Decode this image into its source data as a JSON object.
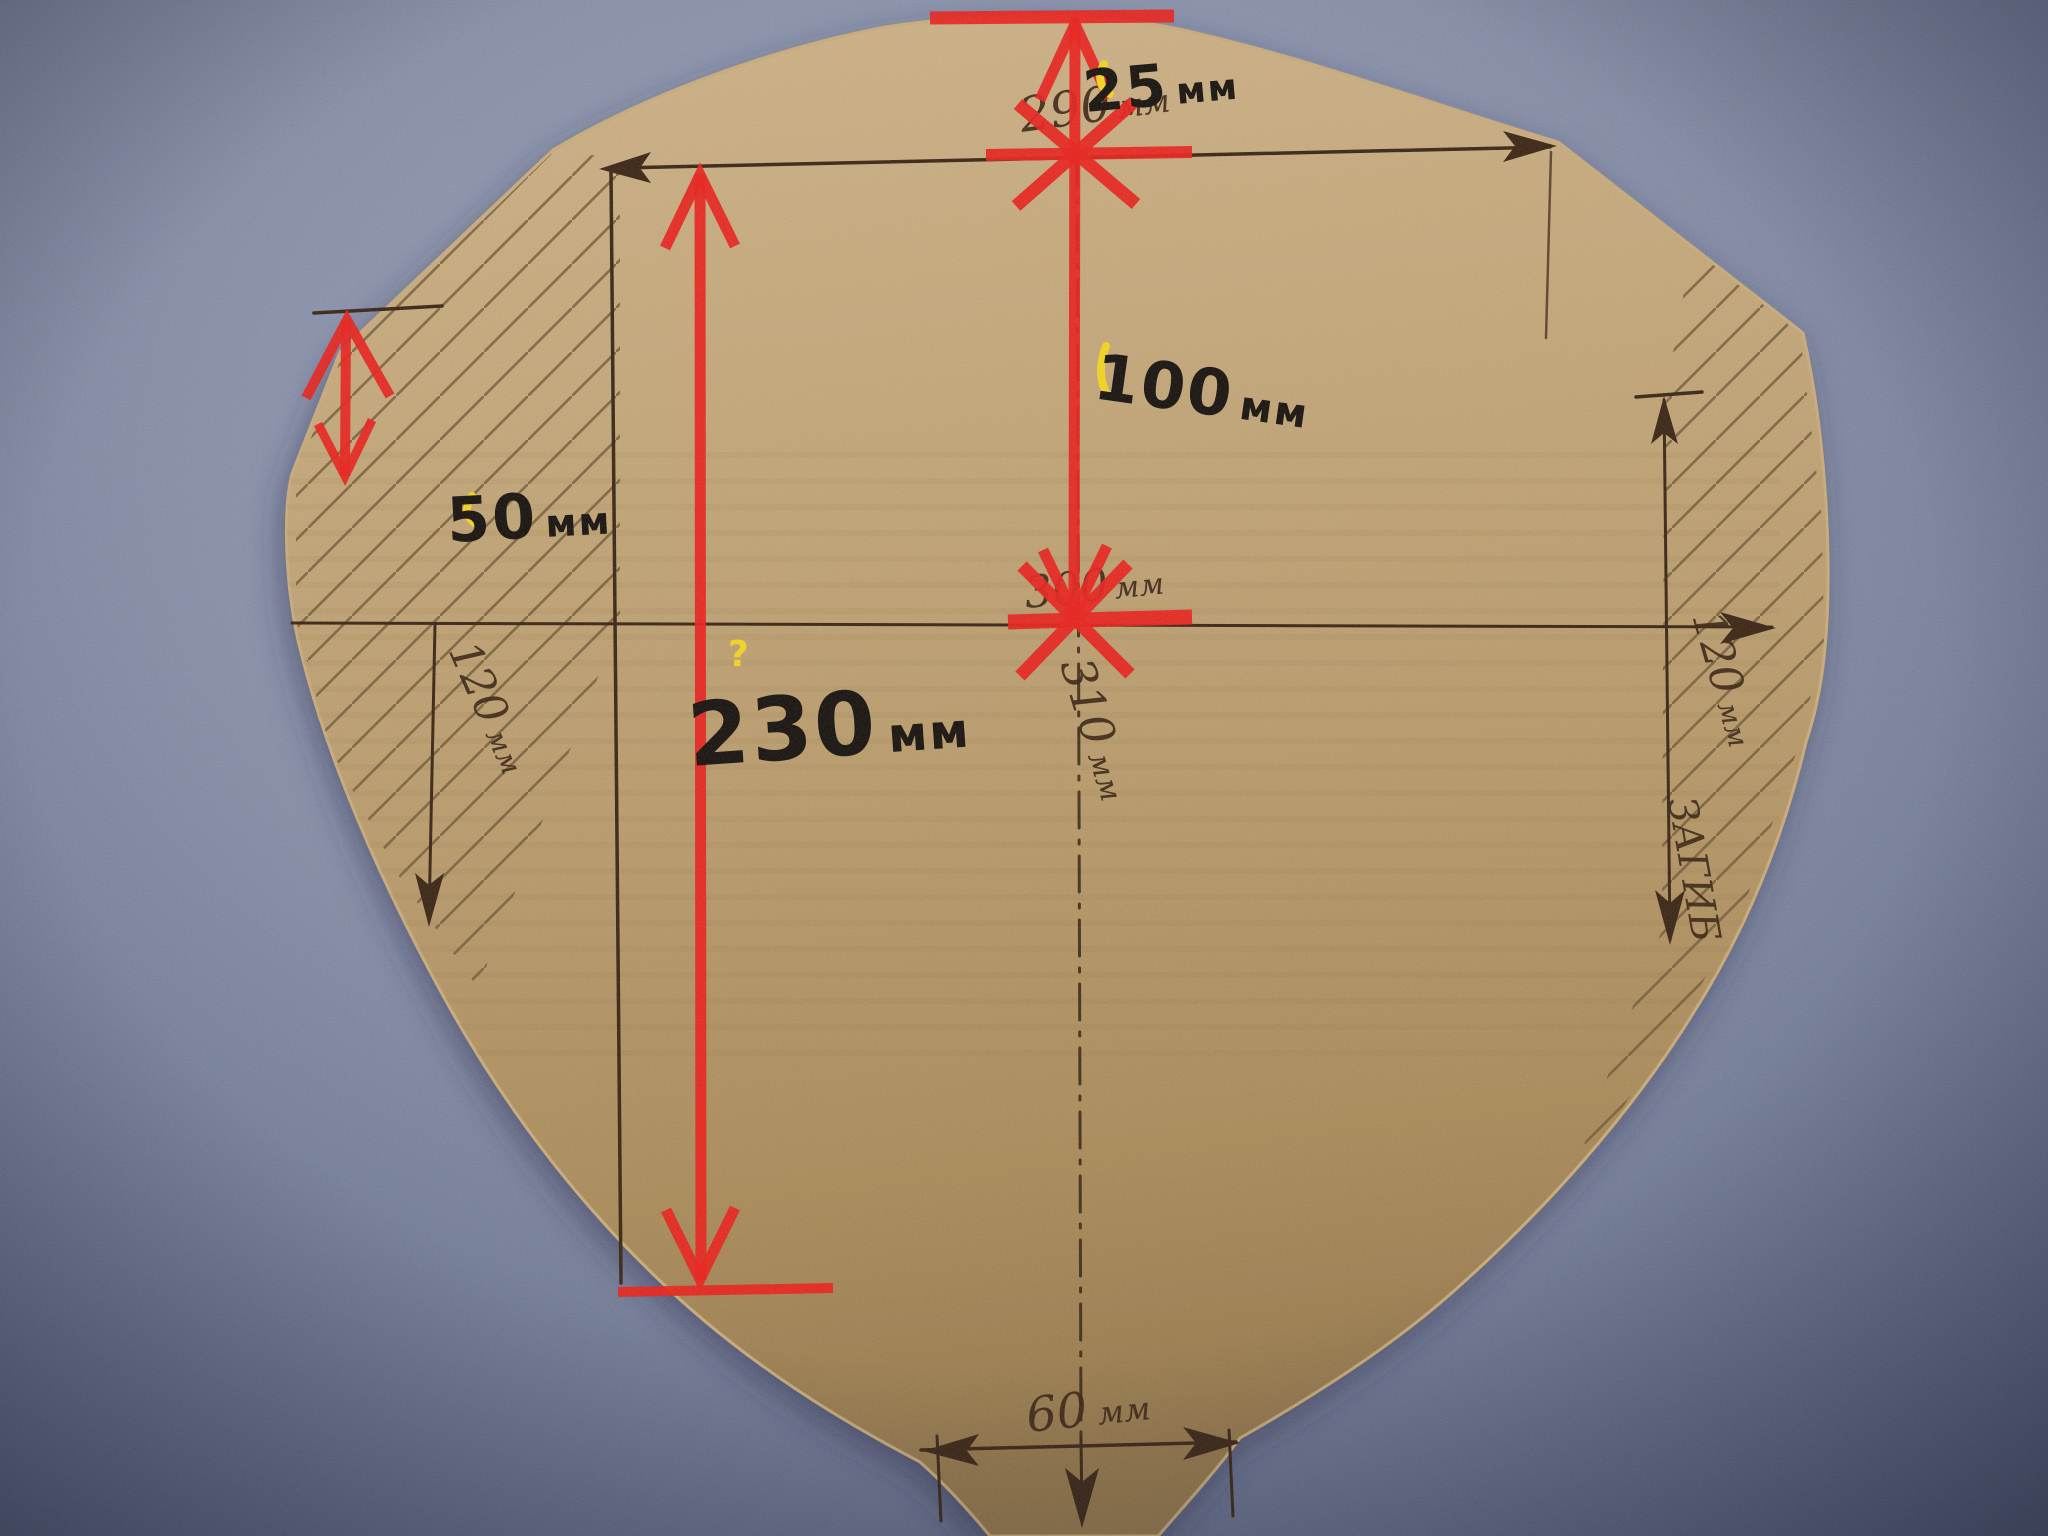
{
  "colors": {
    "background_fabric": "#7f89a3",
    "cardboard": "#c0a273",
    "cardboard_shadow": "#97784a",
    "pen_ink": "#3b2514",
    "marker_ink": "#17120d",
    "dimension_red": "#e8211c",
    "highlight_yellow": "#f4d322"
  },
  "annotations": {
    "marker": {
      "top_offset": {
        "value": "25",
        "unit": "мм"
      },
      "upper_height": {
        "value": "100",
        "unit": "мм"
      },
      "corner_depth": {
        "value": "50",
        "unit": "мм"
      },
      "left_height": {
        "value": "230",
        "unit": "мм"
      },
      "question_mark": "?"
    },
    "pen": {
      "top_width": {
        "value": "290",
        "unit": "мм",
        "crossed_out": true
      },
      "center_width": {
        "value": "300",
        "unit": "мм",
        "crossed_out": true
      },
      "center_height": {
        "value": "310",
        "unit": "мм"
      },
      "left_fold_width": {
        "value": "120",
        "unit": "мм"
      },
      "right_fold_width": {
        "value": "120",
        "unit": "мм"
      },
      "right_fold_note": "ЗАГИБ",
      "bottom_width": {
        "value": "60",
        "unit": "мм"
      }
    }
  }
}
